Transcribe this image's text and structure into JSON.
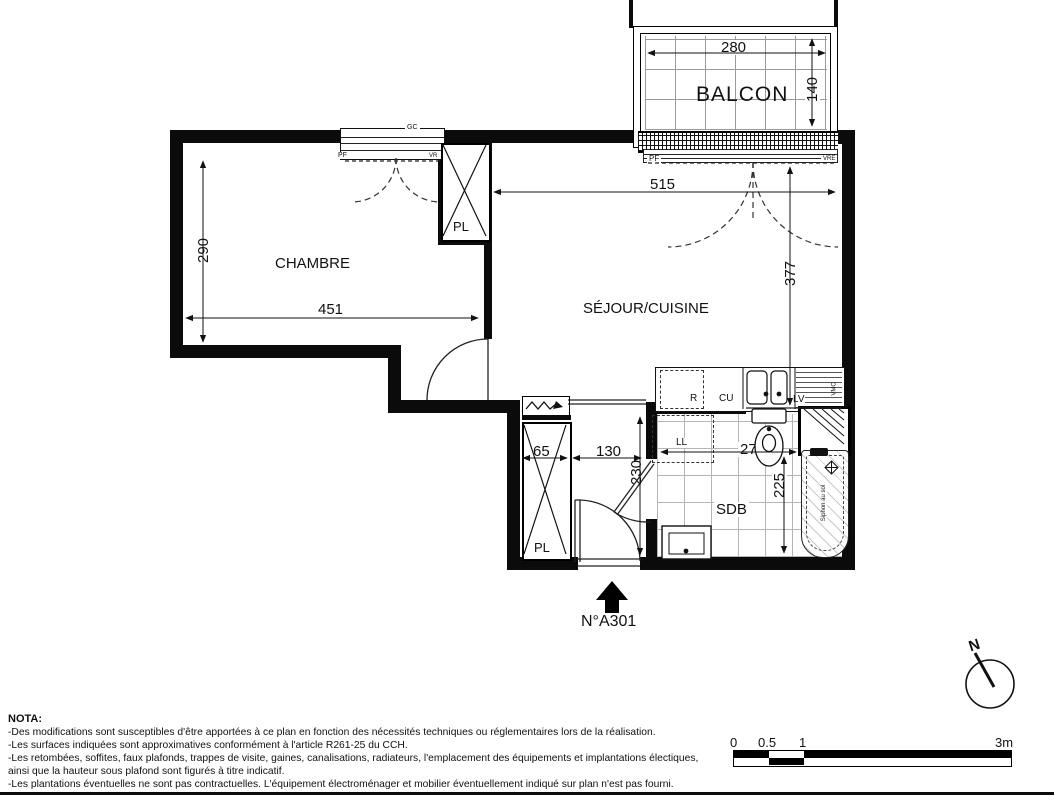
{
  "plan": {
    "rooms": {
      "balcon": "BALCON",
      "chambre": "CHAMBRE",
      "sejour": "SÉJOUR/CUISINE",
      "sdb": "SDB"
    },
    "closets": {
      "pl1": "PL",
      "pl2": "PL"
    },
    "windows": {
      "gc": "GC",
      "pf_chambre": "PF",
      "vr_chambre": "VR",
      "pf_sejour": "PF",
      "vre_sejour": "VRE"
    },
    "equipment": {
      "r": "R",
      "cu": "CU",
      "lv": "LV",
      "ll": "LL",
      "vmc": "VMC",
      "siphon": "Siphon au sol"
    },
    "dims": {
      "balcon_width": "280",
      "balcon_depth": "140",
      "chambre_height": "290",
      "chambre_width": "451",
      "sejour_width": "515",
      "sejour_depth": "377",
      "pl_width": "65",
      "hall_width": "130",
      "hall_depth": "230",
      "sdb_width": "276",
      "sdb_depth": "225"
    },
    "unit_number": "N°A301",
    "north": "N"
  },
  "nota": {
    "title": "NOTA:",
    "lines": [
      "-Des modifications sont susceptibles d'être apportées à ce plan en fonction des nécessités techniques ou réglementaires lors de la réalisation.",
      "-Les surfaces indiquées sont approximatives conformément à l'article R261-25 du CCH.",
      "-Les retombées, soffites, faux plafonds, trappes de visite, gaines, canalisations, radiateurs, l'emplacement des équipements et implantations électiques,",
      "ainsi que la hauteur sous plafond sont figurés à titre indicatif.",
      "-Les plantations éventuelles ne sont pas contractuelles. L'équipement électroménager et mobilier éventuellement indiqué sur plan n'est pas fourni."
    ]
  },
  "scale": {
    "t0": "0",
    "t05": "0.5",
    "t1": "1",
    "t3": "3m"
  }
}
